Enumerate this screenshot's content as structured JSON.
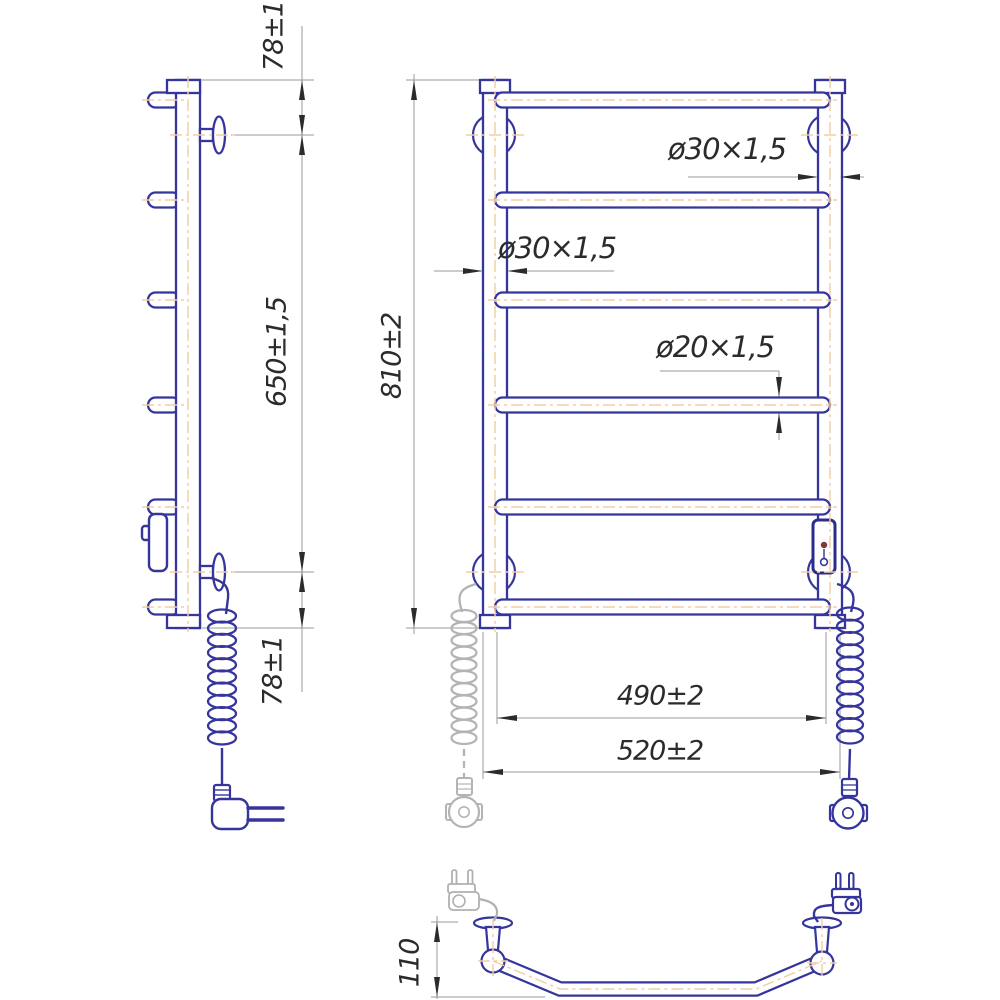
{
  "drawing": {
    "dimensions": {
      "side_top_offset": "78±1",
      "side_rail_span": "650±1,5",
      "side_bottom_offset": "78±1",
      "front_overall_height": "810±2",
      "right_post_tube": "ø30×1,5",
      "left_post_tube": "ø30×1,5",
      "crossbar_tube": "ø20×1,5",
      "mounting_width": "490±2",
      "overall_width": "520±2",
      "wall_clearance": "110"
    },
    "colors": {
      "outline_blue": "#35359b",
      "centerline_orange": "#f3cda2",
      "dimension_line_gray": "#9a9a9a",
      "dimension_text": "#2b2b2b",
      "phantom_gray": "#b4b4b4",
      "indicator_dot": "#7a3b3b",
      "background": "#ffffff"
    }
  }
}
